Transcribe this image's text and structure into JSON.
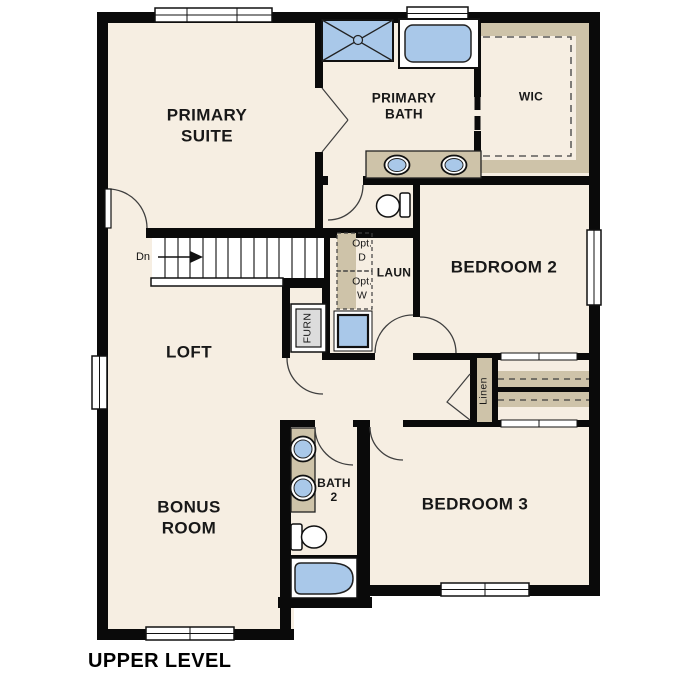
{
  "title": "UPPER LEVEL",
  "rooms": {
    "primary_suite": {
      "line1": "PRIMARY",
      "line2": "SUITE"
    },
    "primary_bath": {
      "line1": "PRIMARY",
      "line2": "BATH"
    },
    "wic": {
      "label": "WIC"
    },
    "bedroom2": {
      "label": "BEDROOM 2"
    },
    "loft": {
      "label": "LOFT"
    },
    "laundry": {
      "label": "LAUN"
    },
    "bedroom3": {
      "label": "BEDROOM 3"
    },
    "bonus_room": {
      "line1": "BONUS",
      "line2": "ROOM"
    },
    "bath2": {
      "line1": "BATH",
      "line2": "2"
    },
    "linen": {
      "label": "Linen"
    },
    "furnace": {
      "label": "FURN"
    }
  },
  "annotations": {
    "stair_direction": "Dn",
    "opt_dryer": {
      "line1": "Opt.",
      "line2": "D"
    },
    "opt_washer": {
      "line1": "Opt.",
      "line2": "W"
    }
  },
  "colors": {
    "wall": "#0a0a0a",
    "floor": "#f6eee2",
    "tan": "#cec3a9",
    "blue": "#a9c8e9",
    "gray": "#dcdcdc",
    "line": "#3f3f3f",
    "ink": "#181818"
  }
}
